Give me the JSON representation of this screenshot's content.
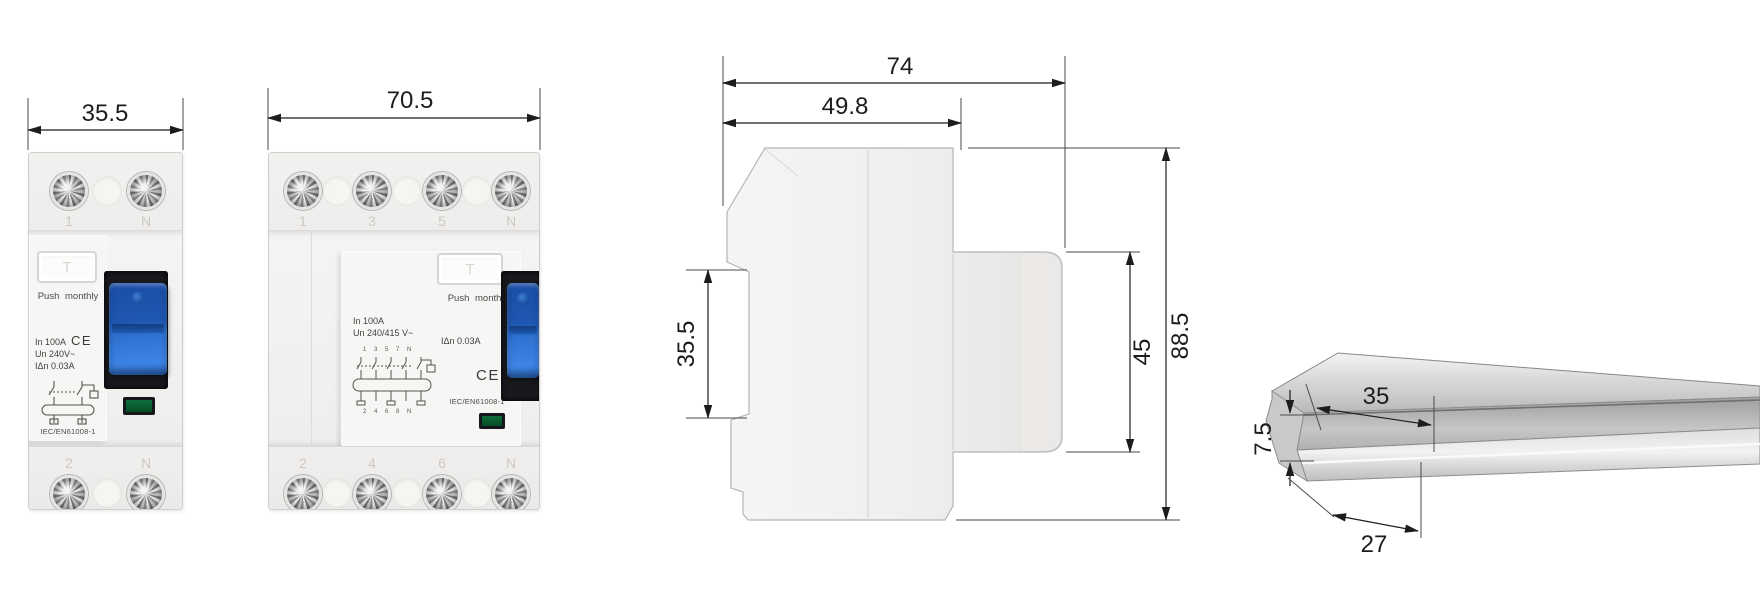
{
  "drawing": {
    "front_2pole": {
      "dim_width": "35.5",
      "terminals_top": [
        "1",
        "N"
      ],
      "terminals_bottom": [
        "2",
        "N"
      ],
      "test_button": "T",
      "push_label": "Push monthly",
      "spec_in": "In 100A",
      "ce_mark": "CE",
      "spec_un": "Un 240V~",
      "spec_idn": "IΔn 0.03A",
      "standard": "IEC/EN61008-1"
    },
    "front_4pole": {
      "dim_width": "70.5",
      "terminals_top": [
        "1",
        "3",
        "5",
        "N"
      ],
      "terminals_bottom": [
        "2",
        "4",
        "6",
        "N"
      ],
      "test_button": "T",
      "push_label": "Push monthly",
      "spec_in": "In 100A",
      "ce_mark": "CE",
      "spec_un": "Un 240/415 V~",
      "spec_idn": "IΔn 0.03A",
      "standard": "IEC/EN61008-1",
      "wiring_labels_top": "1 3 5 7 N",
      "wiring_labels_bottom": "2 4 6 8 N"
    },
    "side_view": {
      "dim_total_depth": "74",
      "dim_body_depth": "49.8",
      "dim_din_slot_height": "35.5",
      "dim_front_section_height": "45",
      "dim_total_height": "88.5"
    },
    "din_rail": {
      "dim_top_width": "35",
      "dim_height": "7.5",
      "dim_bottom_width": "27"
    },
    "colors": {
      "toggle_blue": "#2b6cc8",
      "indicator_green": "#0b5c2f",
      "body_light": "#f2f1ef",
      "dimension_ink": "#1c1c1c"
    }
  }
}
